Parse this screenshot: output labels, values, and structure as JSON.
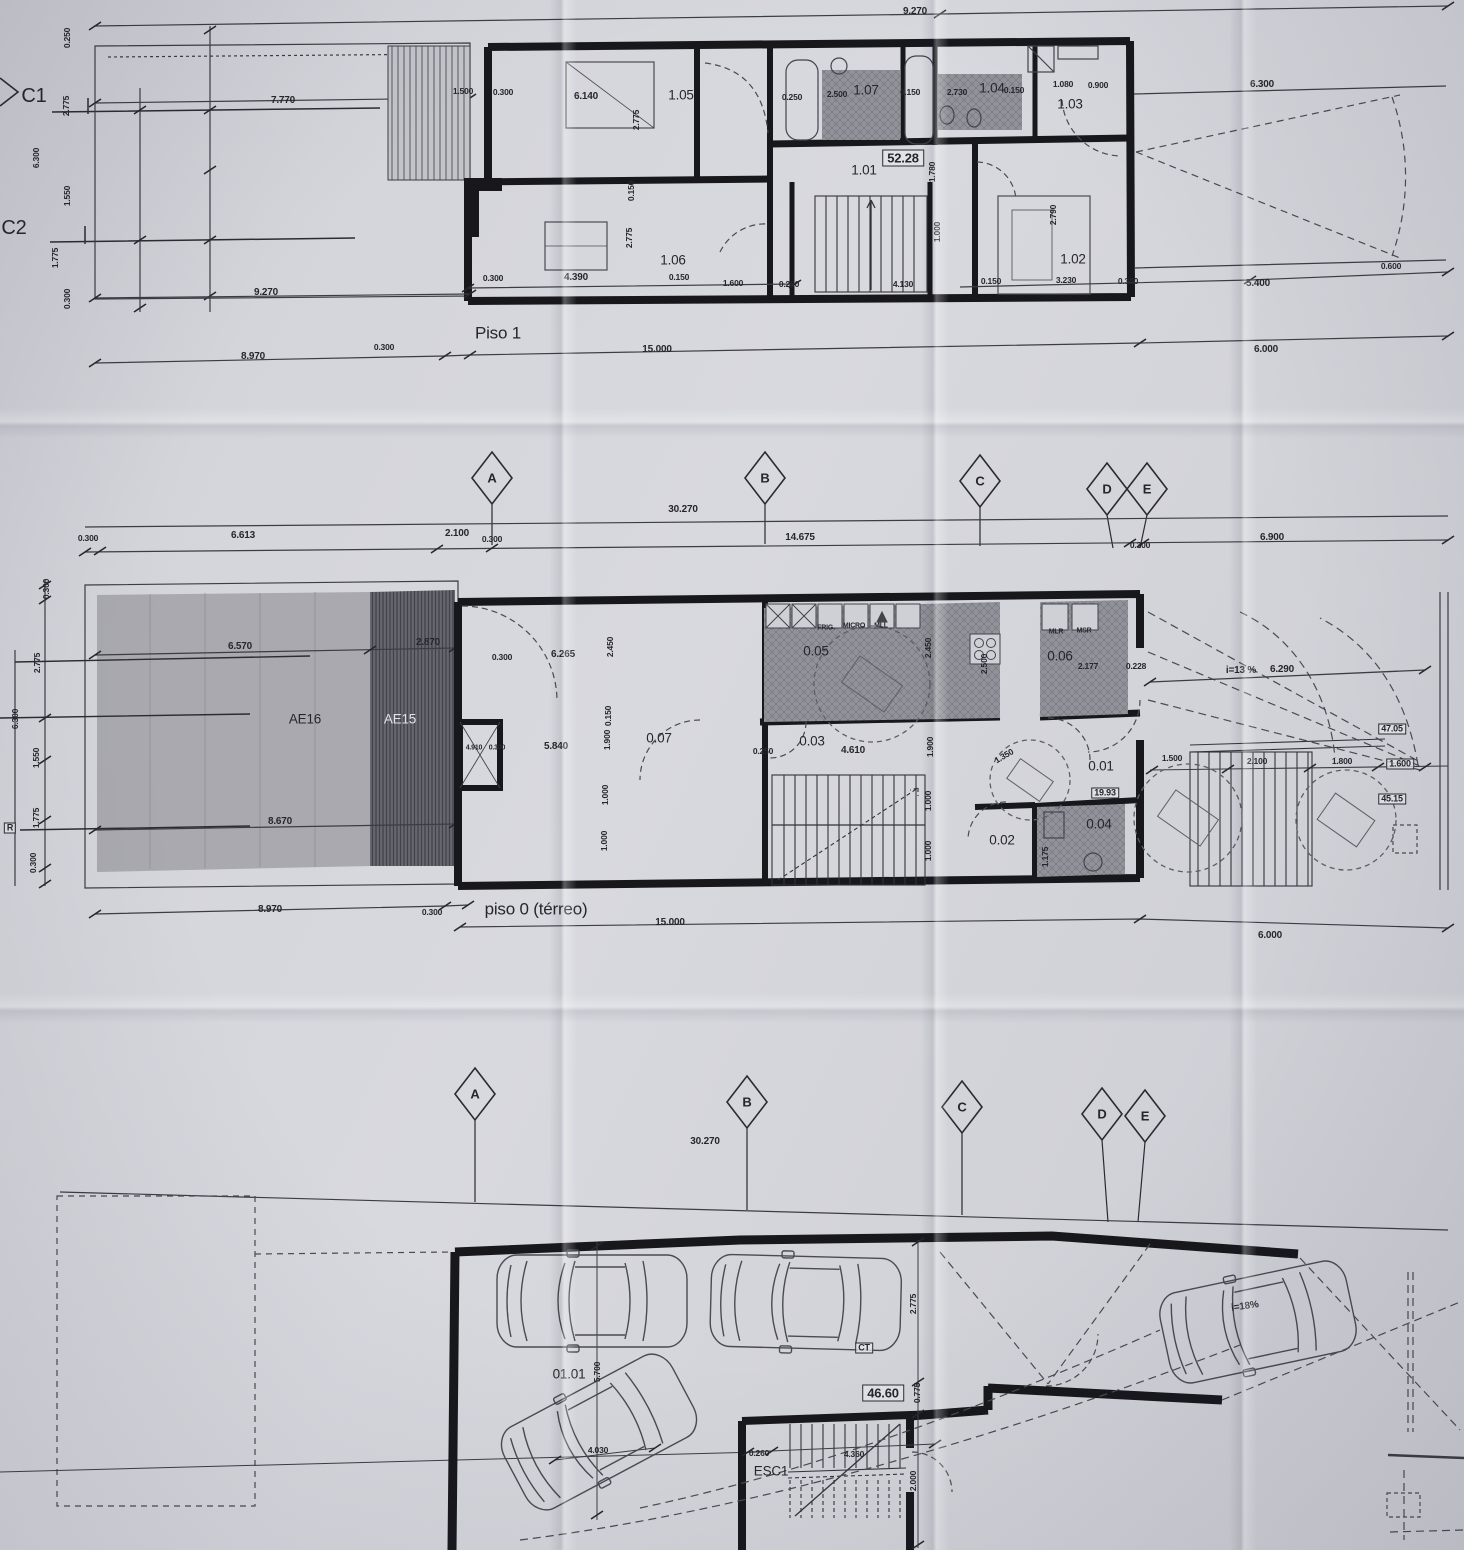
{
  "sheet": {
    "plans": {
      "piso1": {
        "title": "Piso 1"
      },
      "piso0": {
        "title": "piso 0 (térreo)"
      },
      "garagem": {
        "title": ""
      }
    },
    "labels": [
      {
        "t": "9.270",
        "x": 915,
        "y": 12,
        "c": "dim"
      },
      {
        "t": "C1",
        "x": 34,
        "y": 96,
        "c": "big",
        "n": "grid-row-label-c1"
      },
      {
        "t": "C2",
        "x": 14,
        "y": 228,
        "c": "big",
        "n": "grid-row-label-c2"
      },
      {
        "t": "0.250",
        "x": 67,
        "y": 38,
        "c": "tiny",
        "r": -90
      },
      {
        "t": "2.775",
        "x": 66,
        "y": 106,
        "c": "tiny",
        "r": -90
      },
      {
        "t": "6.300",
        "x": 36,
        "y": 158,
        "c": "tiny",
        "r": -90
      },
      {
        "t": "1.550",
        "x": 67,
        "y": 196,
        "c": "tiny",
        "r": -90
      },
      {
        "t": "1.775",
        "x": 55,
        "y": 258,
        "c": "tiny",
        "r": -90
      },
      {
        "t": "0.300",
        "x": 67,
        "y": 299,
        "c": "tiny",
        "r": -90
      },
      {
        "t": "7.770",
        "x": 283,
        "y": 101,
        "c": "dim"
      },
      {
        "t": "1.500",
        "x": 463,
        "y": 91,
        "c": "tiny"
      },
      {
        "t": "0.300",
        "x": 503,
        "y": 92,
        "c": "tiny"
      },
      {
        "t": "6.140",
        "x": 586,
        "y": 97,
        "c": "dim"
      },
      {
        "t": "1.05",
        "x": 681,
        "y": 95,
        "c": "room"
      },
      {
        "t": "2.775",
        "x": 636,
        "y": 120,
        "c": "tiny",
        "r": -90
      },
      {
        "t": "0.250",
        "x": 792,
        "y": 97,
        "c": "tiny"
      },
      {
        "t": "2.500",
        "x": 837,
        "y": 94,
        "c": "tiny"
      },
      {
        "t": "1.07",
        "x": 866,
        "y": 90,
        "c": "room"
      },
      {
        "t": "0.150",
        "x": 910,
        "y": 92,
        "c": "tiny"
      },
      {
        "t": "2.730",
        "x": 957,
        "y": 92,
        "c": "tiny"
      },
      {
        "t": "1.04",
        "x": 992,
        "y": 88,
        "c": "room"
      },
      {
        "t": "0.150",
        "x": 1014,
        "y": 90,
        "c": "tiny"
      },
      {
        "t": "1.080",
        "x": 1063,
        "y": 84,
        "c": "tiny"
      },
      {
        "t": "0.900",
        "x": 1098,
        "y": 85,
        "c": "tiny"
      },
      {
        "t": "1.03",
        "x": 1070,
        "y": 104,
        "c": "room"
      },
      {
        "t": "6.300",
        "x": 1262,
        "y": 85,
        "c": "dim"
      },
      {
        "t": "52.28",
        "x": 903,
        "y": 158,
        "c": "boxed area",
        "n": "area-label"
      },
      {
        "t": "1.01",
        "x": 864,
        "y": 170,
        "c": "room"
      },
      {
        "t": "1.780",
        "x": 932,
        "y": 172,
        "c": "tiny",
        "r": -90
      },
      {
        "t": "0.150",
        "x": 631,
        "y": 191,
        "c": "tiny",
        "r": -90
      },
      {
        "t": "2.775",
        "x": 629,
        "y": 238,
        "c": "tiny",
        "r": -90
      },
      {
        "t": "1.000",
        "x": 937,
        "y": 232,
        "c": "tiny",
        "r": -90
      },
      {
        "t": "2.790",
        "x": 1053,
        "y": 215,
        "c": "tiny",
        "r": -90
      },
      {
        "t": "1.06",
        "x": 673,
        "y": 260,
        "c": "room"
      },
      {
        "t": "1.02",
        "x": 1073,
        "y": 259,
        "c": "room"
      },
      {
        "t": "0.300",
        "x": 493,
        "y": 278,
        "c": "tiny"
      },
      {
        "t": "4.390",
        "x": 576,
        "y": 278,
        "c": "dim"
      },
      {
        "t": "0.150",
        "x": 679,
        "y": 277,
        "c": "tiny"
      },
      {
        "t": "1.600",
        "x": 733,
        "y": 283,
        "c": "tiny"
      },
      {
        "t": "0.250",
        "x": 789,
        "y": 284,
        "c": "tiny"
      },
      {
        "t": "4.130",
        "x": 903,
        "y": 284,
        "c": "tiny"
      },
      {
        "t": "0.150",
        "x": 991,
        "y": 281,
        "c": "tiny"
      },
      {
        "t": "3.230",
        "x": 1066,
        "y": 280,
        "c": "tiny"
      },
      {
        "t": "0.300",
        "x": 1128,
        "y": 281,
        "c": "tiny"
      },
      {
        "t": "5.400",
        "x": 1258,
        "y": 284,
        "c": "dim"
      },
      {
        "t": "0.600",
        "x": 1391,
        "y": 266,
        "c": "tiny"
      },
      {
        "t": "9.270",
        "x": 266,
        "y": 293,
        "c": "dim"
      },
      {
        "t": "8.970",
        "x": 253,
        "y": 357,
        "c": "dim"
      },
      {
        "t": "0.300",
        "x": 384,
        "y": 347,
        "c": "tiny"
      },
      {
        "t": "15.000",
        "x": 657,
        "y": 350,
        "c": "dim"
      },
      {
        "t": "6.000",
        "x": 1266,
        "y": 350,
        "c": "dim"
      },
      {
        "t": "A",
        "x": 492,
        "y": 478,
        "c": "grid",
        "n": "grid-bubble-a"
      },
      {
        "t": "B",
        "x": 765,
        "y": 478,
        "c": "grid",
        "n": "grid-bubble-b"
      },
      {
        "t": "C",
        "x": 980,
        "y": 481,
        "c": "grid",
        "n": "grid-bubble-c"
      },
      {
        "t": "D",
        "x": 1107,
        "y": 489,
        "c": "grid",
        "n": "grid-bubble-d"
      },
      {
        "t": "E",
        "x": 1147,
        "y": 489,
        "c": "grid",
        "n": "grid-bubble-e"
      },
      {
        "t": "30.270",
        "x": 683,
        "y": 510,
        "c": "dim"
      },
      {
        "t": "0.300",
        "x": 88,
        "y": 538,
        "c": "tiny"
      },
      {
        "t": "6.613",
        "x": 243,
        "y": 536,
        "c": "dim"
      },
      {
        "t": "2.100",
        "x": 457,
        "y": 534,
        "c": "dim"
      },
      {
        "t": "0.300",
        "x": 492,
        "y": 539,
        "c": "tiny"
      },
      {
        "t": "14.675",
        "x": 800,
        "y": 538,
        "c": "dim"
      },
      {
        "t": "0.300",
        "x": 1140,
        "y": 545,
        "c": "tiny"
      },
      {
        "t": "6.900",
        "x": 1272,
        "y": 538,
        "c": "dim"
      },
      {
        "t": "6.570",
        "x": 240,
        "y": 647,
        "c": "dim"
      },
      {
        "t": "2.870",
        "x": 428,
        "y": 643,
        "c": "dim"
      },
      {
        "t": "AE16",
        "x": 305,
        "y": 719,
        "c": "room",
        "n": "zone-label-ae16"
      },
      {
        "t": "AE15",
        "x": 400,
        "y": 719,
        "c": "room light",
        "n": "zone-label-ae15"
      },
      {
        "t": "8.670",
        "x": 280,
        "y": 822,
        "c": "dim"
      },
      {
        "t": "0.300",
        "x": 46,
        "y": 589,
        "c": "tiny",
        "r": -90
      },
      {
        "t": "2.775",
        "x": 37,
        "y": 663,
        "c": "tiny",
        "r": -90
      },
      {
        "t": "6.300",
        "x": 15,
        "y": 719,
        "c": "tiny",
        "r": -90
      },
      {
        "t": "1.550",
        "x": 36,
        "y": 758,
        "c": "tiny",
        "r": -90
      },
      {
        "t": "1.775",
        "x": 36,
        "y": 818,
        "c": "tiny",
        "r": -90
      },
      {
        "t": "0.300",
        "x": 33,
        "y": 863,
        "c": "tiny",
        "r": -90
      },
      {
        "t": "R",
        "x": 10,
        "y": 828,
        "c": "boxed tiny2",
        "n": "ref-box-label"
      },
      {
        "t": "0.300",
        "x": 502,
        "y": 657,
        "c": "tiny"
      },
      {
        "t": "6.265",
        "x": 563,
        "y": 655,
        "c": "dim"
      },
      {
        "t": "2.450",
        "x": 610,
        "y": 647,
        "c": "tiny",
        "r": -90
      },
      {
        "t": "0.150",
        "x": 608,
        "y": 716,
        "c": "tiny",
        "r": -90
      },
      {
        "t": "1.900",
        "x": 607,
        "y": 740,
        "c": "tiny",
        "r": -90
      },
      {
        "t": "5.840",
        "x": 556,
        "y": 747,
        "c": "dim"
      },
      {
        "t": "0.07",
        "x": 659,
        "y": 738,
        "c": "room"
      },
      {
        "t": "4.910",
        "x": 474,
        "y": 748,
        "c": "micro"
      },
      {
        "t": "0.300",
        "x": 497,
        "y": 748,
        "c": "micro"
      },
      {
        "t": "1.000",
        "x": 605,
        "y": 795,
        "c": "tiny",
        "r": -90
      },
      {
        "t": "1.000",
        "x": 604,
        "y": 841,
        "c": "tiny",
        "r": -90
      },
      {
        "t": "0.05",
        "x": 816,
        "y": 651,
        "c": "room"
      },
      {
        "t": "FRIG.",
        "x": 826,
        "y": 628,
        "c": "micro",
        "n": "appliance-label-frig"
      },
      {
        "t": "MICRO",
        "x": 854,
        "y": 626,
        "c": "micro",
        "n": "appliance-label-micro"
      },
      {
        "t": "MLL",
        "x": 881,
        "y": 626,
        "c": "micro",
        "n": "appliance-label-mll"
      },
      {
        "t": "2.450",
        "x": 928,
        "y": 648,
        "c": "tiny",
        "r": -90
      },
      {
        "t": "2.500",
        "x": 984,
        "y": 664,
        "c": "tiny",
        "r": -90
      },
      {
        "t": "0.06",
        "x": 1060,
        "y": 656,
        "c": "room"
      },
      {
        "t": "2.177",
        "x": 1088,
        "y": 666,
        "c": "tiny"
      },
      {
        "t": "0.228",
        "x": 1136,
        "y": 666,
        "c": "tiny"
      },
      {
        "t": "MLR",
        "x": 1056,
        "y": 632,
        "c": "micro",
        "n": "appliance-label-mlr"
      },
      {
        "t": "MSR",
        "x": 1084,
        "y": 631,
        "c": "micro",
        "n": "appliance-label-msr"
      },
      {
        "t": "0.03",
        "x": 812,
        "y": 741,
        "c": "room"
      },
      {
        "t": "0.250",
        "x": 763,
        "y": 751,
        "c": "tiny"
      },
      {
        "t": "4.610",
        "x": 853,
        "y": 751,
        "c": "dim"
      },
      {
        "t": "1.900",
        "x": 930,
        "y": 747,
        "c": "tiny",
        "r": -90
      },
      {
        "t": "1.000",
        "x": 928,
        "y": 801,
        "c": "tiny",
        "r": -90
      },
      {
        "t": "1.000",
        "x": 928,
        "y": 851,
        "c": "tiny",
        "r": -90
      },
      {
        "t": "1.350",
        "x": 1004,
        "y": 756,
        "c": "tiny",
        "r": -30
      },
      {
        "t": "0.01",
        "x": 1101,
        "y": 766,
        "c": "room"
      },
      {
        "t": "19.93",
        "x": 1105,
        "y": 793,
        "c": "boxed tiny2",
        "n": "area-label"
      },
      {
        "t": "0.04",
        "x": 1099,
        "y": 824,
        "c": "room"
      },
      {
        "t": "0.02",
        "x": 1002,
        "y": 840,
        "c": "room"
      },
      {
        "t": "1.175",
        "x": 1045,
        "y": 857,
        "c": "tiny",
        "r": -90
      },
      {
        "t": "i=13 %",
        "x": 1241,
        "y": 671,
        "c": "dim",
        "n": "slope-label"
      },
      {
        "t": "6.290",
        "x": 1282,
        "y": 670,
        "c": "dim"
      },
      {
        "t": "47.05",
        "x": 1392,
        "y": 729,
        "c": "boxed tiny2",
        "n": "area-label"
      },
      {
        "t": "1.500",
        "x": 1172,
        "y": 758,
        "c": "tiny"
      },
      {
        "t": "2.100",
        "x": 1257,
        "y": 761,
        "c": "tiny"
      },
      {
        "t": "1.800",
        "x": 1342,
        "y": 761,
        "c": "tiny"
      },
      {
        "t": "1.600",
        "x": 1400,
        "y": 764,
        "c": "boxed tiny2"
      },
      {
        "t": "45.15",
        "x": 1392,
        "y": 799,
        "c": "boxed tiny2",
        "n": "area-label"
      },
      {
        "t": "8.970",
        "x": 270,
        "y": 910,
        "c": "dim"
      },
      {
        "t": "0.300",
        "x": 432,
        "y": 912,
        "c": "tiny"
      },
      {
        "t": "15.000",
        "x": 670,
        "y": 923,
        "c": "dim"
      },
      {
        "t": "6.000",
        "x": 1270,
        "y": 936,
        "c": "dim"
      },
      {
        "t": "A",
        "x": 475,
        "y": 1094,
        "c": "grid",
        "n": "grid-bubble-a"
      },
      {
        "t": "B",
        "x": 747,
        "y": 1102,
        "c": "grid",
        "n": "grid-bubble-b"
      },
      {
        "t": "C",
        "x": 962,
        "y": 1107,
        "c": "grid",
        "n": "grid-bubble-c"
      },
      {
        "t": "D",
        "x": 1102,
        "y": 1114,
        "c": "grid",
        "n": "grid-bubble-d"
      },
      {
        "t": "E",
        "x": 1145,
        "y": 1116,
        "c": "grid",
        "n": "grid-bubble-e"
      },
      {
        "t": "30.270",
        "x": 705,
        "y": 1142,
        "c": "dim"
      },
      {
        "t": "01.01",
        "x": 569,
        "y": 1374,
        "c": "room"
      },
      {
        "t": "5.700",
        "x": 597,
        "y": 1372,
        "c": "tiny",
        "r": -90
      },
      {
        "t": "4.030",
        "x": 598,
        "y": 1450,
        "c": "tiny"
      },
      {
        "t": "2.775",
        "x": 913,
        "y": 1304,
        "c": "tiny",
        "r": -90
      },
      {
        "t": "CT",
        "x": 864,
        "y": 1348,
        "c": "boxed tiny2",
        "n": "ct-label"
      },
      {
        "t": "46.60",
        "x": 883,
        "y": 1393,
        "c": "boxed area",
        "n": "area-label"
      },
      {
        "t": "0.775",
        "x": 917,
        "y": 1393,
        "c": "tiny",
        "r": -90
      },
      {
        "t": "0.260",
        "x": 759,
        "y": 1453,
        "c": "tiny"
      },
      {
        "t": "4.360",
        "x": 854,
        "y": 1454,
        "c": "tiny"
      },
      {
        "t": "ESC1",
        "x": 771,
        "y": 1471,
        "c": "room",
        "n": "stair-label"
      },
      {
        "t": "2.000",
        "x": 913,
        "y": 1481,
        "c": "tiny",
        "r": -90
      },
      {
        "t": "i=18%",
        "x": 1245,
        "y": 1307,
        "c": "dim",
        "r": -8,
        "n": "slope-label"
      }
    ]
  }
}
